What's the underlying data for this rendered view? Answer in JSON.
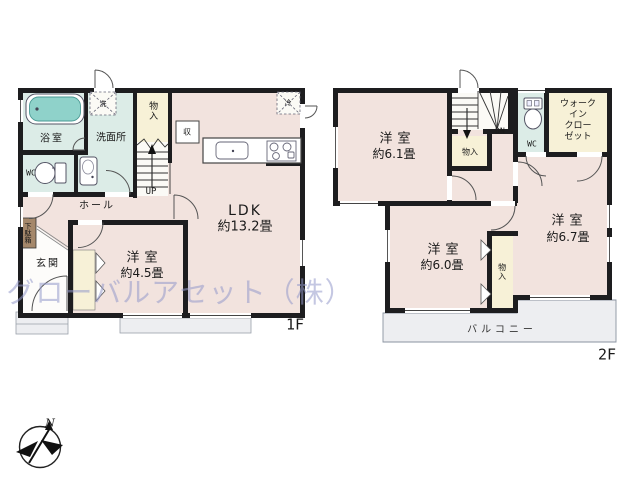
{
  "watermark": "グローバルアセット（株）",
  "compass": {
    "north": "N"
  },
  "floor1": {
    "label": "1F",
    "bath": "浴室",
    "washroom": "洗面所",
    "wc": "WC",
    "stair_storage": "物入",
    "up": "UP",
    "hall": "ホール",
    "shoe_cabinet": "下駄箱",
    "entrance": "玄関",
    "room45_name": "洋室",
    "room45_size": "約4.5畳",
    "ldk_name": "LDK",
    "ldk_size": "約13.2畳",
    "storage": "収",
    "washer": "洗",
    "fridge": "冷"
  },
  "floor2": {
    "label": "2F",
    "room61_name": "洋室",
    "room61_size": "約6.1畳",
    "dn": "DN",
    "stair_storage": "物入",
    "wc": "WC",
    "walk_in_closet": "ウォーク\nイン\nクロー\nゼット",
    "room67_name": "洋室",
    "room67_size": "約6.7畳",
    "room60_name": "洋室",
    "room60_size": "約6.0畳",
    "closet": "物入",
    "balcony": "バルコニー"
  },
  "colors": {
    "wall": "#1d1d1f",
    "room_pink": "#f2e3de",
    "wet_area_teal": "#dcece7",
    "closet_yellow": "#f7f1d7",
    "bathtub_teal": "#8fd2ca",
    "shoe_cabinet_brown": "#a5886b",
    "outdoor_gray": "#edeef1",
    "watermark_purple": "#949bcb"
  }
}
